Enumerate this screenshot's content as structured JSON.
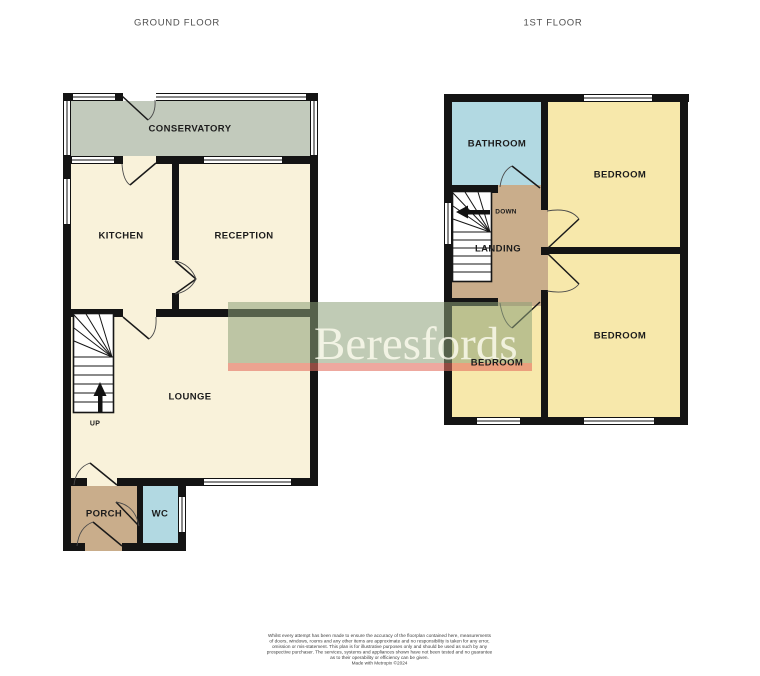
{
  "titles": {
    "ground_floor": "GROUND FLOOR",
    "first_floor": "1ST FLOOR"
  },
  "ground_floor": {
    "conservatory": "CONSERVATORY",
    "kitchen": "KITCHEN",
    "reception": "RECEPTION",
    "lounge": "LOUNGE",
    "porch": "PORCH",
    "wc": "WC",
    "stairs_label": "UP"
  },
  "first_floor": {
    "bathroom": "BATHROOM",
    "bedroom_front": "BEDROOM",
    "bedroom_rear": "BEDROOM",
    "bedroom_side": "BEDROOM",
    "landing": "LANDING",
    "stairs_label": "DOWN"
  },
  "watermark": {
    "brand": "Beresfords",
    "box_color": "#8ca07a",
    "stripe_color": "#e26e5f",
    "text_color": "#fdfbee"
  },
  "colors": {
    "wall": "#141414",
    "floor_cream": "#f9f2da",
    "conservatory_green": "#c2cabc",
    "bathroom_blue": "#b2d9e2",
    "hall_tan": "#c9ad8b",
    "bedroom_yellow": "#f7e8ab"
  },
  "disclaimer": {
    "lines": [
      "Whilst every attempt has been made to ensure the accuracy of the floorplan contained here, measurements",
      "of doors, windows, rooms and any other items are approximate and no responsibility is taken for any error,",
      "omission or mis-statement. This plan is for illustrative purposes only and should be used as such by any",
      "prospective purchaser. The services, systems and appliances shown have not been tested and no guarantee",
      "as to their operability or efficiency can be given.",
      "Made with Metropix ©2024"
    ]
  }
}
